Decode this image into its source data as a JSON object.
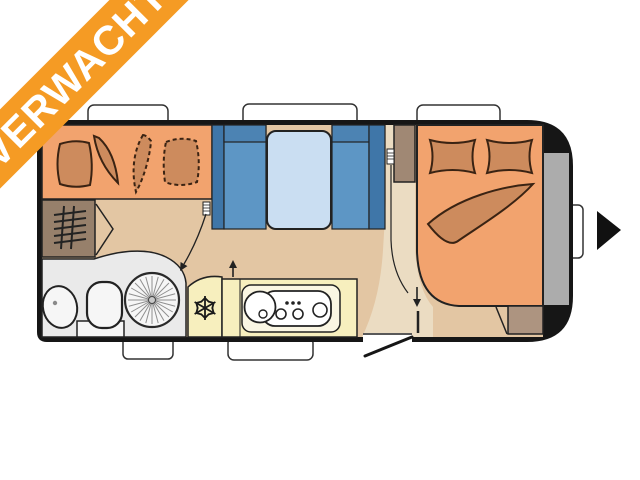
{
  "banner": {
    "label": "VERWACHT",
    "color": "#F59B24",
    "text_color": "#FFFFFF"
  },
  "floorplan": {
    "type": "caravan-top-view-layout",
    "travel_direction": "right",
    "palette": {
      "wall": "#161616",
      "floor": "#E3C6A3",
      "walkway": "#EBDCC2",
      "upholstery": "#F2A36E",
      "cushion": "#CD8B5D",
      "bunk_dark": "#3F76A8",
      "bunk_mid": "#5D96C5",
      "bunk_header": "#4C83B3",
      "mattress": "#CADEF2",
      "kitchen": "#F7EFBE",
      "kitchen_unit": "#FAF6E3",
      "bathroom": "#EAEAEA",
      "fixture": "#F6F6F6",
      "cabinet": "#A08874",
      "heater_cabinet": "#97806B",
      "corner_cabinet": "#AD9480",
      "front_locker": "#ACACAC",
      "window": "#FFFFFF"
    },
    "areas": [
      {
        "id": "dinette",
        "label": "front dinette with four cushions"
      },
      {
        "id": "heater",
        "label": "heater cabinet"
      },
      {
        "id": "bathroom",
        "label": "washroom with sink, toilet and round shower"
      },
      {
        "id": "kitchen",
        "label": "kitchen block with fridge, sink and hob"
      },
      {
        "id": "bunks",
        "label": "blue bunk beds with mattress"
      },
      {
        "id": "wardrobe",
        "label": "wardrobe cabinet"
      },
      {
        "id": "bed",
        "label": "double bed with two pillows and blanket"
      },
      {
        "id": "front-locker",
        "label": "front storage locker"
      }
    ]
  }
}
